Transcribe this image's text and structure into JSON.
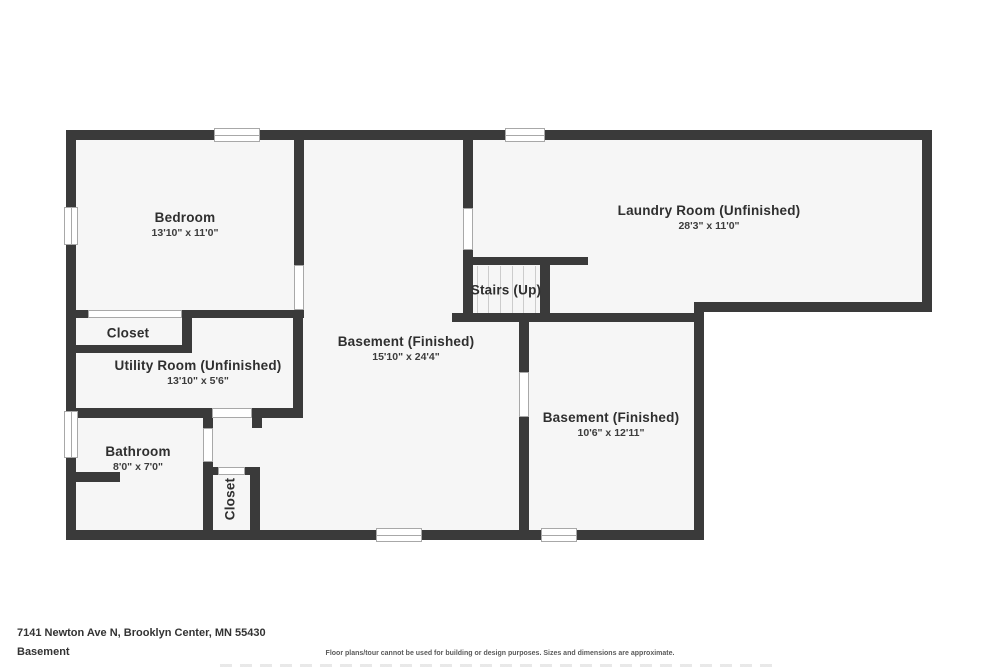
{
  "footer": {
    "address": "7141 Newton Ave N, Brooklyn Center, MN 55430",
    "level_label": "Basement",
    "disclaimer": "Floor plans/tour cannot be used for building or design purposes. Sizes and dimensions are approximate."
  },
  "colors": {
    "wall": "#3a3a3a",
    "room_fill": "#f6f6f6",
    "opening_border": "#a8a8a8",
    "tread_line": "#cccccc",
    "label_text": "#2f2f2f"
  },
  "floorplan": {
    "fills": [
      {
        "x": 66,
        "y": 130,
        "w": 866,
        "h": 182
      },
      {
        "x": 66,
        "y": 130,
        "w": 638,
        "h": 410
      }
    ],
    "walls": [
      {
        "id": "exterior-top",
        "x": 66,
        "y": 130,
        "w": 866,
        "h": 10
      },
      {
        "id": "exterior-left",
        "x": 66,
        "y": 130,
        "w": 10,
        "h": 410
      },
      {
        "id": "exterior-right-upper",
        "x": 922,
        "y": 130,
        "w": 10,
        "h": 182
      },
      {
        "id": "laundry-bottom",
        "x": 694,
        "y": 302,
        "w": 238,
        "h": 10
      },
      {
        "id": "exterior-right-lower",
        "x": 694,
        "y": 302,
        "w": 10,
        "h": 238
      },
      {
        "id": "exterior-bottom",
        "x": 66,
        "y": 530,
        "w": 638,
        "h": 10
      },
      {
        "id": "bedroom-right",
        "x": 294,
        "y": 140,
        "w": 10,
        "h": 125
      },
      {
        "id": "bedroom-bottom-stub",
        "x": 66,
        "y": 310,
        "w": 22,
        "h": 8
      },
      {
        "id": "bedroom-bottom-main",
        "x": 182,
        "y": 310,
        "w": 122,
        "h": 8
      },
      {
        "id": "closet-upper-right",
        "x": 182,
        "y": 310,
        "w": 10,
        "h": 43
      },
      {
        "id": "closet-upper-bottom",
        "x": 66,
        "y": 345,
        "w": 126,
        "h": 8
      },
      {
        "id": "utility-right",
        "x": 293,
        "y": 318,
        "w": 10,
        "h": 100
      },
      {
        "id": "utility-bottom-left",
        "x": 66,
        "y": 408,
        "w": 146,
        "h": 10
      },
      {
        "id": "utility-bottom-right",
        "x": 252,
        "y": 408,
        "w": 51,
        "h": 10
      },
      {
        "id": "utility-corner-stub",
        "x": 252,
        "y": 418,
        "w": 10,
        "h": 10
      },
      {
        "id": "bathroom-right-stub",
        "x": 203,
        "y": 418,
        "w": 10,
        "h": 10
      },
      {
        "id": "bathroom-right-lower",
        "x": 203,
        "y": 462,
        "w": 10,
        "h": 78
      },
      {
        "id": "bathroom-inner-stub",
        "x": 66,
        "y": 472,
        "w": 54,
        "h": 10
      },
      {
        "id": "closet-lower-top-left",
        "x": 208,
        "y": 467,
        "w": 10,
        "h": 8
      },
      {
        "id": "closet-lower-top-right",
        "x": 245,
        "y": 467,
        "w": 15,
        "h": 8
      },
      {
        "id": "closet-lower-right",
        "x": 250,
        "y": 467,
        "w": 10,
        "h": 73
      },
      {
        "id": "laundry-left-upper",
        "x": 463,
        "y": 140,
        "w": 10,
        "h": 68
      },
      {
        "id": "laundry-left-lower",
        "x": 463,
        "y": 250,
        "w": 10,
        "h": 15
      },
      {
        "id": "stairs-top",
        "x": 463,
        "y": 257,
        "w": 125,
        "h": 8
      },
      {
        "id": "stairs-left",
        "x": 463,
        "y": 265,
        "w": 10,
        "h": 50
      },
      {
        "id": "stairs-right",
        "x": 540,
        "y": 265,
        "w": 10,
        "h": 53
      },
      {
        "id": "basement-right-top",
        "x": 452,
        "y": 313,
        "w": 252,
        "h": 9
      },
      {
        "id": "basement-right-left-up",
        "x": 519,
        "y": 313,
        "w": 10,
        "h": 59
      },
      {
        "id": "basement-right-left-low",
        "x": 519,
        "y": 417,
        "w": 10,
        "h": 123
      }
    ],
    "openings": [
      {
        "id": "bedroom-door",
        "x": 294,
        "y": 265,
        "w": 10,
        "h": 45
      },
      {
        "id": "closet-upper-front",
        "x": 88,
        "y": 310,
        "w": 94,
        "h": 8
      },
      {
        "id": "laundry-door",
        "x": 463,
        "y": 208,
        "w": 10,
        "h": 42
      },
      {
        "id": "utility-door",
        "x": 212,
        "y": 408,
        "w": 40,
        "h": 10
      },
      {
        "id": "bathroom-door",
        "x": 203,
        "y": 428,
        "w": 10,
        "h": 34
      },
      {
        "id": "closet-lower-door",
        "x": 218,
        "y": 467,
        "w": 27,
        "h": 8
      },
      {
        "id": "basement-right-door",
        "x": 519,
        "y": 372,
        "w": 10,
        "h": 45
      }
    ],
    "windows": [
      {
        "id": "window-top-left",
        "x": 214,
        "y": 128,
        "w": 46,
        "h": 14,
        "orient": "h"
      },
      {
        "id": "window-top-center",
        "x": 505,
        "y": 128,
        "w": 40,
        "h": 14,
        "orient": "h"
      },
      {
        "id": "window-left-bedroom",
        "x": 64,
        "y": 207,
        "w": 14,
        "h": 38,
        "orient": "v"
      },
      {
        "id": "window-left-bathroom",
        "x": 64,
        "y": 411,
        "w": 14,
        "h": 47,
        "orient": "v"
      },
      {
        "id": "window-bottom-center",
        "x": 376,
        "y": 528,
        "w": 46,
        "h": 14,
        "orient": "h"
      },
      {
        "id": "window-bottom-right",
        "x": 541,
        "y": 528,
        "w": 36,
        "h": 14,
        "orient": "h"
      }
    ],
    "stair_treads": {
      "xs": [
        477,
        488,
        500,
        512,
        523,
        535
      ],
      "y": 266,
      "height": 47
    },
    "rooms": [
      {
        "id": "bedroom",
        "name": "Bedroom",
        "dims": "13'10\" x 11'0\"",
        "cx": 185,
        "cy": 225,
        "rotate": false
      },
      {
        "id": "closet-upper",
        "name": "Closet",
        "dims": "",
        "cx": 128,
        "cy": 334,
        "rotate": false
      },
      {
        "id": "utility-room",
        "name": "Utility Room (Unfinished)",
        "dims": "13'10\" x 5'6\"",
        "cx": 198,
        "cy": 373,
        "rotate": false
      },
      {
        "id": "bathroom",
        "name": "Bathroom",
        "dims": "8'0\" x 7'0\"",
        "cx": 138,
        "cy": 459,
        "rotate": false
      },
      {
        "id": "closet-lower",
        "name": "Closet",
        "dims": "",
        "cx": 231,
        "cy": 499,
        "rotate": true
      },
      {
        "id": "basement-center",
        "name": "Basement (Finished)",
        "dims": "15'10\" x 24'4\"",
        "cx": 406,
        "cy": 349,
        "rotate": false
      },
      {
        "id": "stairs",
        "name": "Stairs (Up)",
        "dims": "",
        "cx": 506,
        "cy": 291,
        "rotate": false
      },
      {
        "id": "laundry-room",
        "name": "Laundry Room (Unfinished)",
        "dims": "28'3\" x 11'0\"",
        "cx": 709,
        "cy": 218,
        "rotate": false
      },
      {
        "id": "basement-right",
        "name": "Basement (Finished)",
        "dims": "10'6\" x 12'11\"",
        "cx": 611,
        "cy": 425,
        "rotate": false
      }
    ]
  }
}
